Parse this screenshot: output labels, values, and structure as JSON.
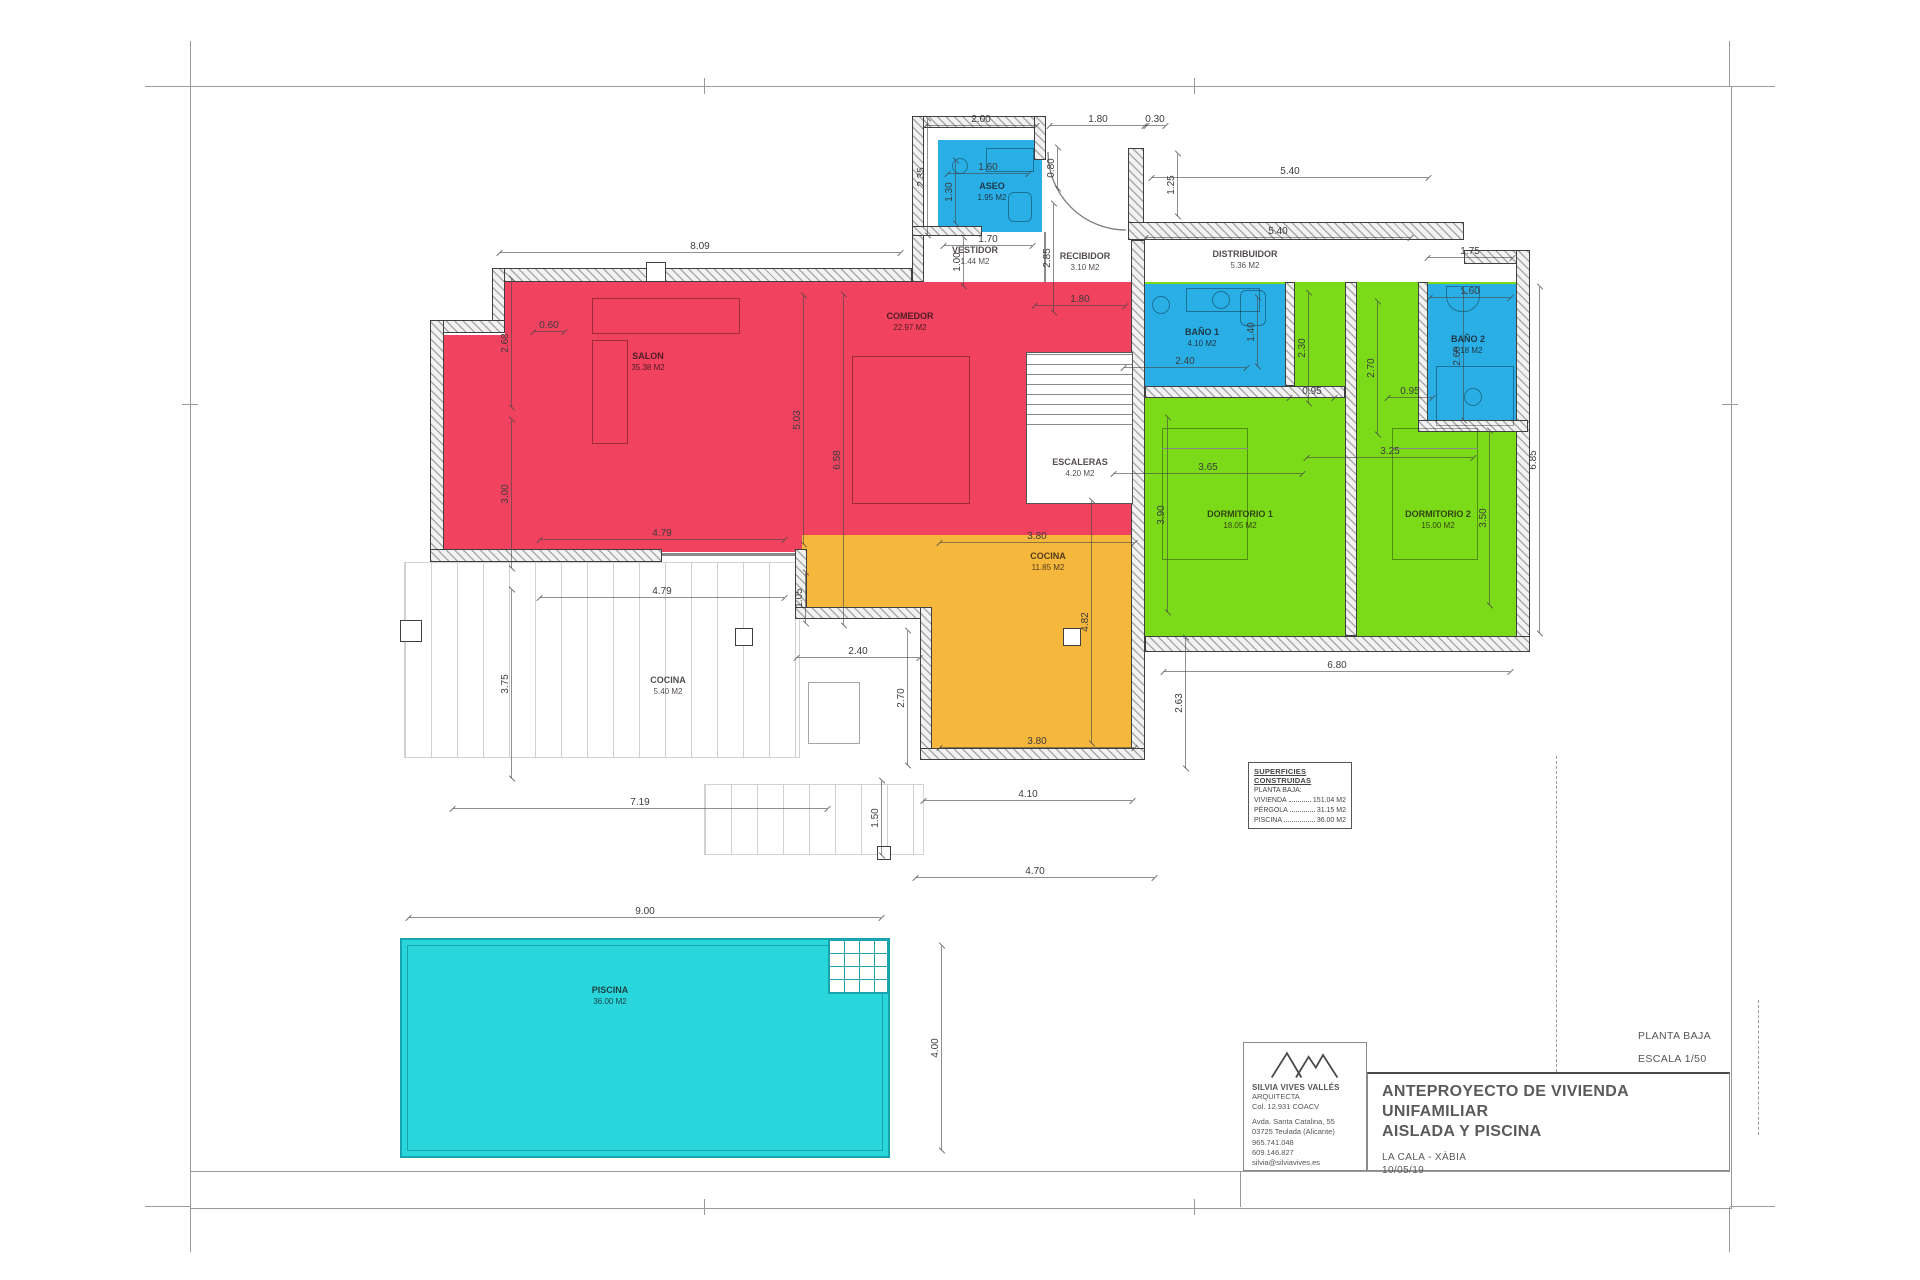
{
  "sheet": {
    "plan_name": "PLANTA BAJA",
    "scale": "ESCALA 1/50",
    "title_line1": "ANTEPROYECTO DE VIVIENDA UNIFAMILIAR",
    "title_line2": "AISLADA Y PISCINA",
    "location": "LA CALA - XÀBIA",
    "date": "10/05/19"
  },
  "architect": {
    "name": "SILVIA VIVES VALLÉS",
    "role": "ARQUITECTA",
    "license": "Col. 12.931 COACV",
    "address1": "Avda. Santa Catalina, 55",
    "address2": "03725 Teulada (Alicante)",
    "phone1": "965.741.048",
    "phone2": "609.146.827",
    "email": "silvia@silviavives.es"
  },
  "legend": {
    "title": "SUPERFICIES CONSTRUIDAS",
    "subtitle": "PLANTA BAJA:",
    "items": [
      {
        "label": "VIVIENDA",
        "value": "151.04 M2"
      },
      {
        "label": "PÉRGOLA",
        "value": "31.15 M2"
      },
      {
        "label": "PISCINA",
        "value": "36.00 M2"
      }
    ]
  },
  "colors": {
    "living": "#f1425f",
    "kitchen": "#f6b83c",
    "bedroom": "#7bdb19",
    "bath": "#2aaee6",
    "pool": "#29d6dc"
  },
  "rooms": [
    {
      "id": "salon",
      "name": "SALON",
      "area": "35.38 M2",
      "x": 648,
      "y": 362
    },
    {
      "id": "comedor",
      "name": "COMEDOR",
      "area": "22.97 M2",
      "x": 910,
      "y": 322
    },
    {
      "id": "recibidor",
      "name": "RECIBIDOR",
      "area": "3.10 M2",
      "x": 1085,
      "y": 262
    },
    {
      "id": "distribuidor",
      "name": "DISTRIBUIDOR",
      "area": "5.36 M2",
      "x": 1245,
      "y": 260
    },
    {
      "id": "aseo",
      "name": "ASEO",
      "area": "1.95 M2",
      "x": 992,
      "y": 192
    },
    {
      "id": "vestidor",
      "name": "VESTIDOR",
      "area": "1.44 M2",
      "x": 975,
      "y": 256
    },
    {
      "id": "escaleras",
      "name": "ESCALERAS",
      "area": "4.20 M2",
      "x": 1080,
      "y": 468
    },
    {
      "id": "bano-1",
      "name": "BAÑO 1",
      "area": "4.10 M2",
      "x": 1202,
      "y": 338
    },
    {
      "id": "bano-2",
      "name": "BAÑO 2",
      "area": "4.18 M2",
      "x": 1468,
      "y": 345
    },
    {
      "id": "dormitorio-1",
      "name": "DORMITORIO 1",
      "area": "18.05 M2",
      "x": 1240,
      "y": 520
    },
    {
      "id": "dormitorio-2",
      "name": "DORMITORIO 2",
      "area": "15.00 M2",
      "x": 1438,
      "y": 520
    },
    {
      "id": "cocina",
      "name": "COCINA",
      "area": "11.85 M2",
      "x": 1048,
      "y": 562
    },
    {
      "id": "cocina-ext",
      "name": "COCINA",
      "area": "5.40 M2",
      "x": 668,
      "y": 686
    },
    {
      "id": "piscina",
      "name": "PISCINA",
      "area": "36.00 M2",
      "x": 610,
      "y": 996
    }
  ],
  "dimensions": [
    {
      "t": "2.00",
      "x": 981,
      "y": 120,
      "o": "h",
      "len": 110
    },
    {
      "t": "1.80",
      "x": 1098,
      "y": 120,
      "o": "h",
      "len": 96
    },
    {
      "t": "0.30",
      "x": 1155,
      "y": 120,
      "o": "h",
      "len": 20
    },
    {
      "t": "0.80",
      "x": 1052,
      "y": 168,
      "o": "v",
      "len": 40
    },
    {
      "t": "2.35",
      "x": 922,
      "y": 177,
      "o": "v",
      "len": 116
    },
    {
      "t": "1.60",
      "x": 988,
      "y": 168,
      "o": "h",
      "len": 80
    },
    {
      "t": "1.30",
      "x": 950,
      "y": 192,
      "o": "v",
      "len": 62
    },
    {
      "t": "1.70",
      "x": 988,
      "y": 240,
      "o": "h",
      "len": 88
    },
    {
      "t": "1.00",
      "x": 958,
      "y": 262,
      "o": "v",
      "len": 48
    },
    {
      "t": "2.85",
      "x": 1048,
      "y": 258,
      "o": "v",
      "len": 108
    },
    {
      "t": "1.25",
      "x": 1172,
      "y": 185,
      "o": "v",
      "len": 62
    },
    {
      "t": "5.40",
      "x": 1290,
      "y": 172,
      "o": "h",
      "len": 276
    },
    {
      "t": "5.40",
      "x": 1278,
      "y": 232,
      "o": "h",
      "len": 264
    },
    {
      "t": "1.75",
      "x": 1470,
      "y": 252,
      "o": "h",
      "len": 84
    },
    {
      "t": "8.09",
      "x": 700,
      "y": 247,
      "o": "h",
      "len": 400
    },
    {
      "t": "1.80",
      "x": 1080,
      "y": 300,
      "o": "h",
      "len": 90
    },
    {
      "t": "2.68",
      "x": 506,
      "y": 343,
      "o": "v",
      "len": 128
    },
    {
      "t": "0.60",
      "x": 549,
      "y": 326,
      "o": "h",
      "len": 30
    },
    {
      "t": "3.00",
      "x": 506,
      "y": 494,
      "o": "v",
      "len": 148
    },
    {
      "t": "3.75",
      "x": 506,
      "y": 684,
      "o": "v",
      "len": 188
    },
    {
      "t": "5.03",
      "x": 798,
      "y": 420,
      "o": "v",
      "len": 248
    },
    {
      "t": "6.58",
      "x": 838,
      "y": 460,
      "o": "v",
      "len": 330
    },
    {
      "t": "2.40",
      "x": 1185,
      "y": 362,
      "o": "h",
      "len": 122
    },
    {
      "t": "1.40",
      "x": 1252,
      "y": 332,
      "o": "v",
      "len": 68
    },
    {
      "t": "2.30",
      "x": 1303,
      "y": 348,
      "o": "v",
      "len": 110
    },
    {
      "t": "0.95",
      "x": 1312,
      "y": 392,
      "o": "h",
      "len": 44
    },
    {
      "t": "1.60",
      "x": 1470,
      "y": 292,
      "o": "h",
      "len": 80
    },
    {
      "t": "2.60",
      "x": 1458,
      "y": 356,
      "o": "v",
      "len": 128
    },
    {
      "t": "0.95",
      "x": 1410,
      "y": 392,
      "o": "h",
      "len": 44
    },
    {
      "t": "2.70",
      "x": 1372,
      "y": 368,
      "o": "v",
      "len": 132
    },
    {
      "t": "3.65",
      "x": 1208,
      "y": 468,
      "o": "h",
      "len": 188
    },
    {
      "t": "3.90",
      "x": 1162,
      "y": 515,
      "o": "v",
      "len": 194
    },
    {
      "t": "3.25",
      "x": 1390,
      "y": 452,
      "o": "h",
      "len": 166
    },
    {
      "t": "3.50",
      "x": 1484,
      "y": 518,
      "o": "v",
      "len": 174
    },
    {
      "t": "4.79",
      "x": 662,
      "y": 534,
      "o": "h",
      "len": 244
    },
    {
      "t": "3.80",
      "x": 1037,
      "y": 537,
      "o": "h",
      "len": 194
    },
    {
      "t": "4.79",
      "x": 662,
      "y": 592,
      "o": "h",
      "len": 244
    },
    {
      "t": "1.05",
      "x": 800,
      "y": 598,
      "o": "v",
      "len": 50
    },
    {
      "t": "2.40",
      "x": 858,
      "y": 652,
      "o": "h",
      "len": 122
    },
    {
      "t": "2.70",
      "x": 902,
      "y": 698,
      "o": "v",
      "len": 134
    },
    {
      "t": "4.82",
      "x": 1086,
      "y": 622,
      "o": "v",
      "len": 242
    },
    {
      "t": "2.63",
      "x": 1180,
      "y": 703,
      "o": "v",
      "len": 130
    },
    {
      "t": "6.80",
      "x": 1337,
      "y": 666,
      "o": "h",
      "len": 346
    },
    {
      "t": "6.85",
      "x": 1534,
      "y": 460,
      "o": "v",
      "len": 346
    },
    {
      "t": "3.80",
      "x": 1037,
      "y": 742,
      "o": "h",
      "len": 194
    },
    {
      "t": "7.19",
      "x": 640,
      "y": 803,
      "o": "h",
      "len": 374
    },
    {
      "t": "4.10",
      "x": 1028,
      "y": 795,
      "o": "h",
      "len": 208
    },
    {
      "t": "1.50",
      "x": 876,
      "y": 818,
      "o": "v",
      "len": 74
    },
    {
      "t": "4.70",
      "x": 1035,
      "y": 872,
      "o": "h",
      "len": 238
    },
    {
      "t": "9.00",
      "x": 645,
      "y": 912,
      "o": "h",
      "len": 472
    },
    {
      "t": "4.00",
      "x": 936,
      "y": 1048,
      "o": "v",
      "len": 204
    }
  ]
}
